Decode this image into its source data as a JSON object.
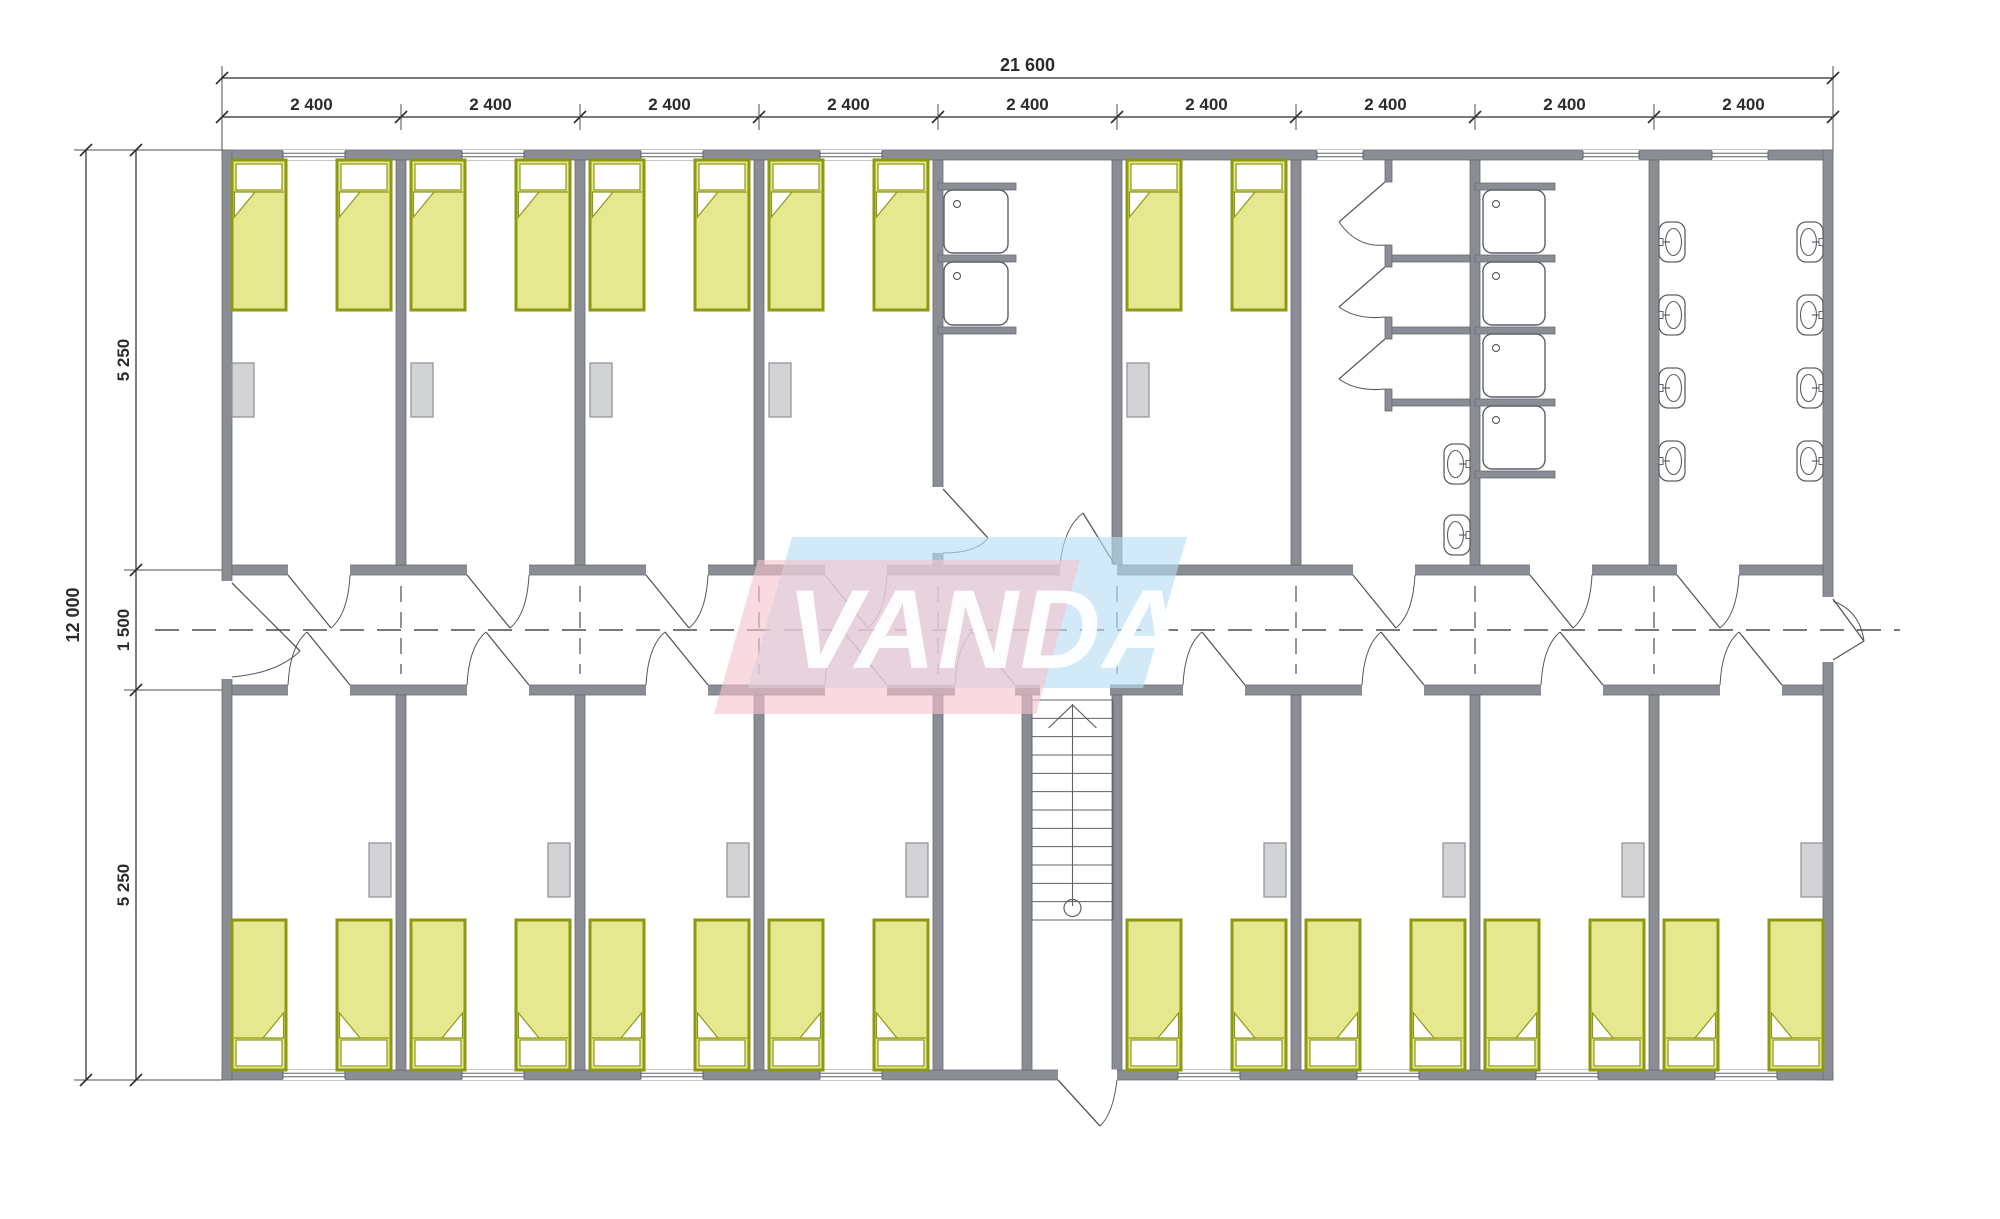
{
  "watermark": {
    "text": "VANDA",
    "blue": "#b7ddf3",
    "pink": "#f6c3cd",
    "text_color": "#ffffff"
  },
  "dim_labels": {
    "top_total": "21 600",
    "top_segment": "2 400",
    "left_total": "12 000",
    "left_top": "5 250",
    "left_mid": "1 500",
    "left_bottom": "5 250"
  },
  "colors": {
    "floor": "#ffffff",
    "wall": "#8b8d95",
    "wall_edge": "#696b72",
    "bed_fill": "#e6e88f",
    "bed_edge": "#8e9912",
    "pillow": "#ffffff",
    "wardrobe_fill": "#d2d3d5",
    "wardrobe_edge": "#8f9096",
    "fixture": "#5f6167",
    "dash": "#4c4c4c",
    "dim": "#2b2b2b",
    "door": "#55575e"
  },
  "plan": {
    "origin_x": 222,
    "origin_y": 150,
    "module_w": 179,
    "modules": 9,
    "height": 930,
    "wall": 10,
    "corridor_top": 565,
    "corridor_bottom": 695,
    "top_bedrooms": [
      0,
      1,
      2,
      3,
      5
    ],
    "bottom_bedrooms": [
      0,
      1,
      2,
      3,
      5,
      6,
      7,
      8
    ],
    "bed": {
      "w": 54,
      "h": 150
    },
    "wardrobe": {
      "w": 22,
      "h": 54,
      "top_y": 363,
      "bottom_y": 843
    },
    "top_windows": [
      [
        0,
        283,
        62
      ],
      [
        1,
        462,
        62
      ],
      [
        2,
        641,
        62
      ],
      [
        3,
        820,
        62
      ],
      [
        6,
        1317,
        46
      ],
      [
        7,
        1583,
        56
      ],
      [
        8,
        1712,
        56
      ]
    ],
    "bottom_windows": [
      [
        0,
        283,
        62
      ],
      [
        1,
        462,
        62
      ],
      [
        2,
        641,
        62
      ],
      [
        3,
        820,
        62
      ],
      [
        5,
        1178,
        62
      ],
      [
        6,
        1357,
        62
      ],
      [
        7,
        1536,
        62
      ],
      [
        8,
        1715,
        62
      ]
    ],
    "top_doors": [
      288,
      467,
      646,
      825,
      1183,
      1353,
      1530,
      1677
    ],
    "bottom_doors": [
      288,
      467,
      646,
      825,
      1183,
      1362,
      1541,
      1720
    ],
    "door_w": 62,
    "closet_door": {
      "x": 955,
      "w": 60
    },
    "stair_opening": {
      "x": 1040,
      "w": 70
    },
    "washroom_door_side": {
      "gap_y": 487,
      "gap_h": 66
    },
    "sink_units": {
      "x": 944,
      "w": 64,
      "h": 63,
      "ys": [
        190,
        262
      ],
      "stub_x": 938,
      "stub_w": 78,
      "stub_ys": [
        183,
        255,
        327
      ]
    },
    "shower_trays": {
      "x": 1483,
      "w": 62,
      "h": 63,
      "ys": [
        190,
        262,
        334,
        406
      ],
      "stub_x": 1475,
      "stub_w": 80,
      "stub_ys": [
        183,
        255,
        327,
        399,
        471
      ]
    },
    "wc_stalls": {
      "front_x": 1385,
      "front_w": 7,
      "stub_ys": [
        [
          160,
          22
        ],
        [
          245,
          22
        ],
        [
          317,
          22
        ],
        [
          389,
          22
        ]
      ],
      "partitions": {
        "x": 1392,
        "w": 78,
        "ys": [
          255,
          327,
          399
        ]
      },
      "door_gaps": [
        [
          182,
          245
        ],
        [
          267,
          317
        ],
        [
          339,
          389
        ]
      ]
    },
    "wc_basins": {
      "x": 1444,
      "w": 26,
      "h": 40,
      "ys": [
        444,
        515
      ],
      "facing": "left"
    },
    "washroom_basins": {
      "left_x": 1659,
      "right_x": 1797,
      "w": 26,
      "h": 40,
      "ys": [
        222,
        295,
        368,
        441
      ]
    },
    "stairs": {
      "wall_x": 1022,
      "x": 1032,
      "w": 81,
      "top": 700,
      "bottom": 920,
      "treads": 13
    },
    "entrance_bottom": {
      "x": 1058,
      "w": 59
    },
    "entrance_left": {
      "y": 581,
      "h": 98
    },
    "exit_right": {
      "y": 597,
      "h": 65
    }
  },
  "inventory": {
    "beds": 26,
    "wardrobes": 13,
    "wash_basins": 10,
    "shower_trays": 4,
    "wc_stalls": 3,
    "sink_units": 2,
    "staircases": 1,
    "windows": 15
  }
}
